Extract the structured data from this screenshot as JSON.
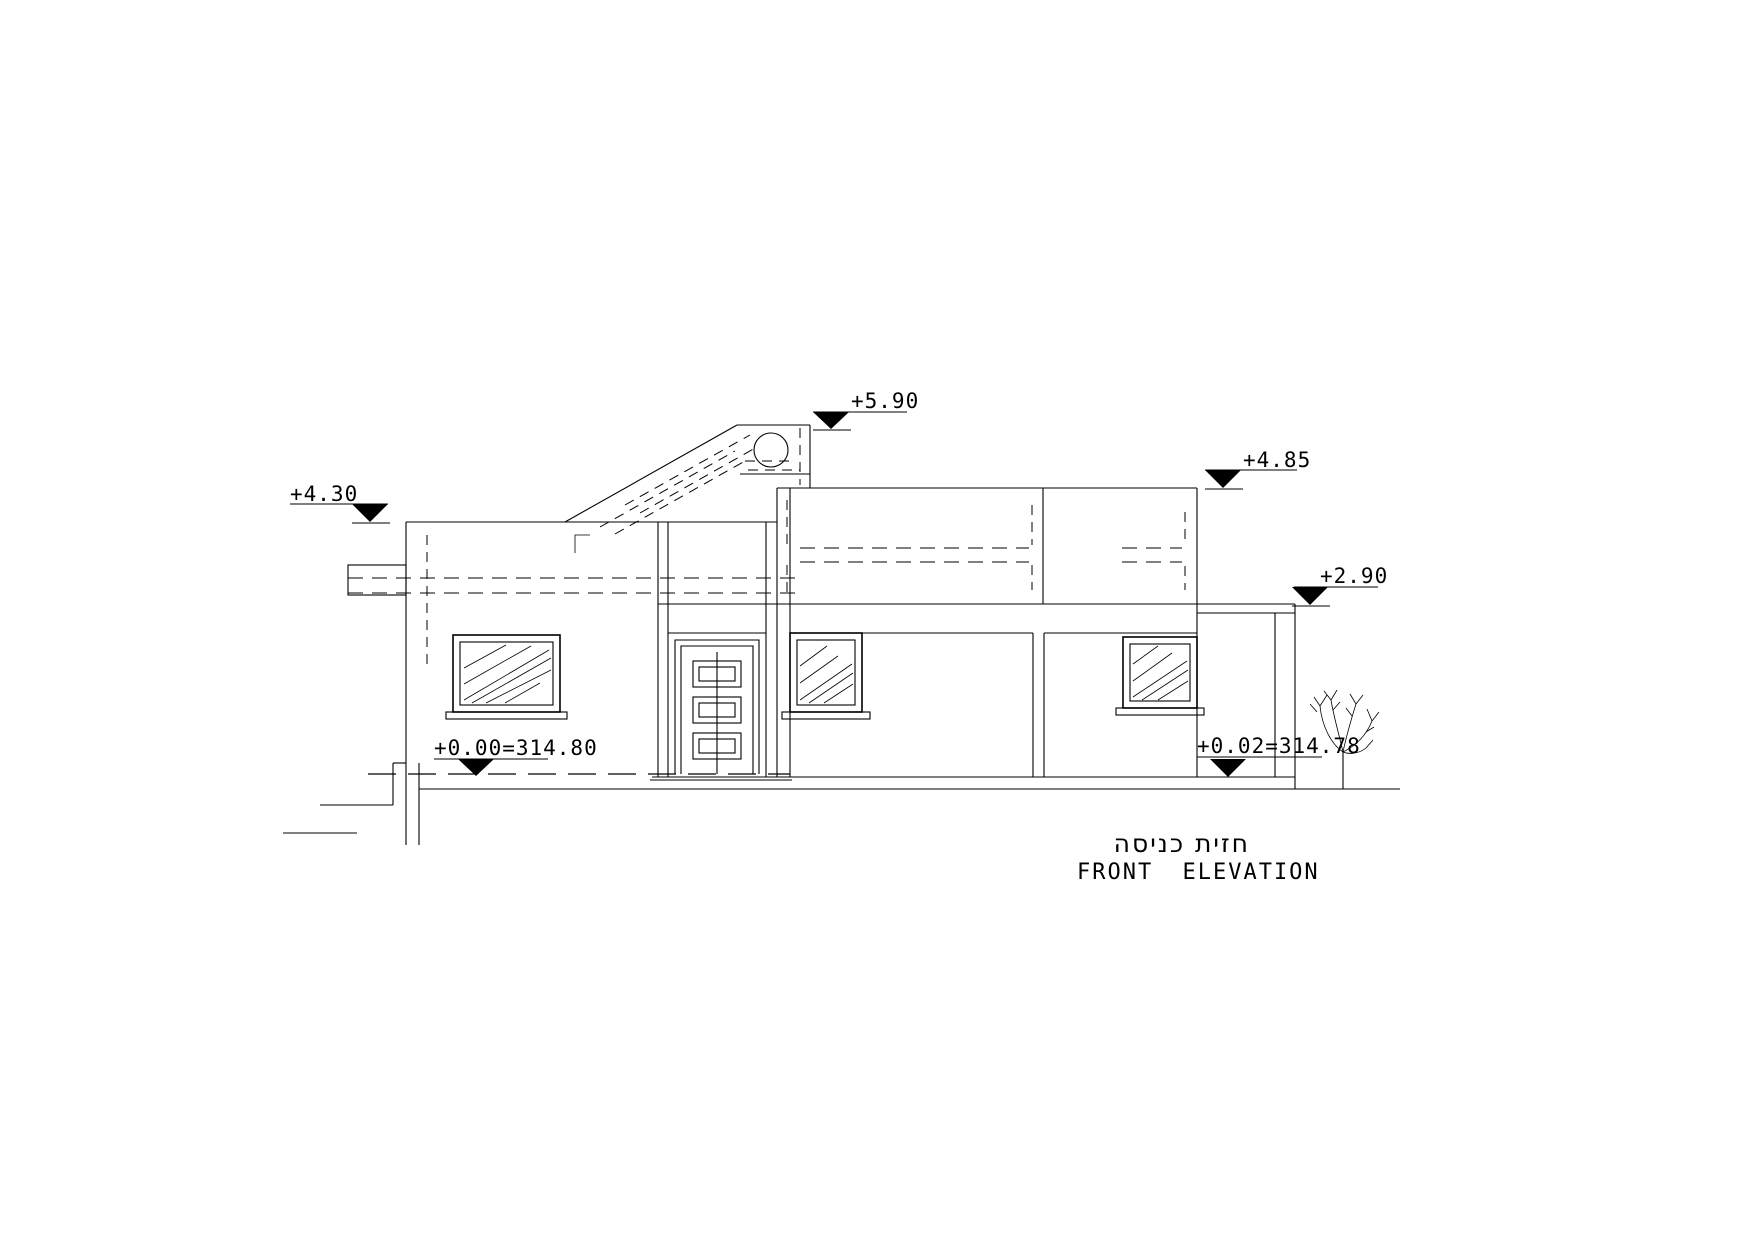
{
  "drawing": {
    "title_hebrew": "חזית כניסה",
    "title_english": "FRONT ELEVATION",
    "background_color": "#ffffff",
    "line_color": "#000000"
  },
  "elevation_markers": [
    {
      "id": "solar-heater-top",
      "label": "+5.90"
    },
    {
      "id": "upper-parapet",
      "label": "+4.85"
    },
    {
      "id": "left-parapet",
      "label": "+4.30"
    },
    {
      "id": "lower-slab",
      "label": "+2.90"
    },
    {
      "id": "floor-level",
      "label": "+0.00=314.80"
    },
    {
      "id": "entrance-level",
      "label": "+0.02=314.78"
    }
  ]
}
